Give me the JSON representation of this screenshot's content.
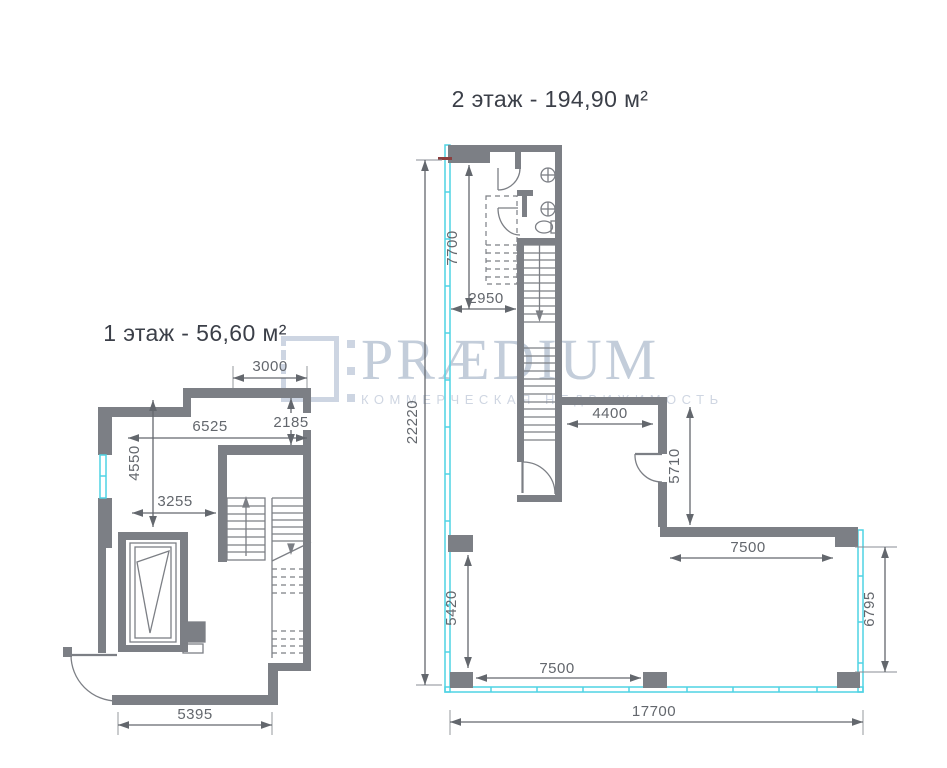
{
  "watermark": {
    "brand": "PRÆDIUM",
    "tagline": "КОММЕРЧЕСКАЯ НЕДВИЖИМОСТЬ"
  },
  "floor1": {
    "title": "1 этаж - 56,60 м²",
    "dims": {
      "top_width": "3000",
      "right_height": "2185",
      "main_width": "6525",
      "left_height": "4550",
      "inner_width": "3255",
      "bottom_width": "5395"
    }
  },
  "floor2": {
    "title": "2 этаж - 194,90 м²",
    "dims": {
      "entry_height": "7700",
      "entry_width": "2950",
      "total_height": "22220",
      "corridor_width": "4400",
      "room_height": "5710",
      "room_width": "7500",
      "right_height": "6795",
      "lower_left_height": "5420",
      "bottom_inner_width": "7500",
      "total_width": "17700"
    }
  },
  "colors": {
    "wall": "#7c7f85",
    "dimension": "#63676d",
    "glazing": "#4fd3e4",
    "title": "#3b3f48",
    "watermark": "#c3cdda",
    "entry_marker": "#8b4040"
  }
}
